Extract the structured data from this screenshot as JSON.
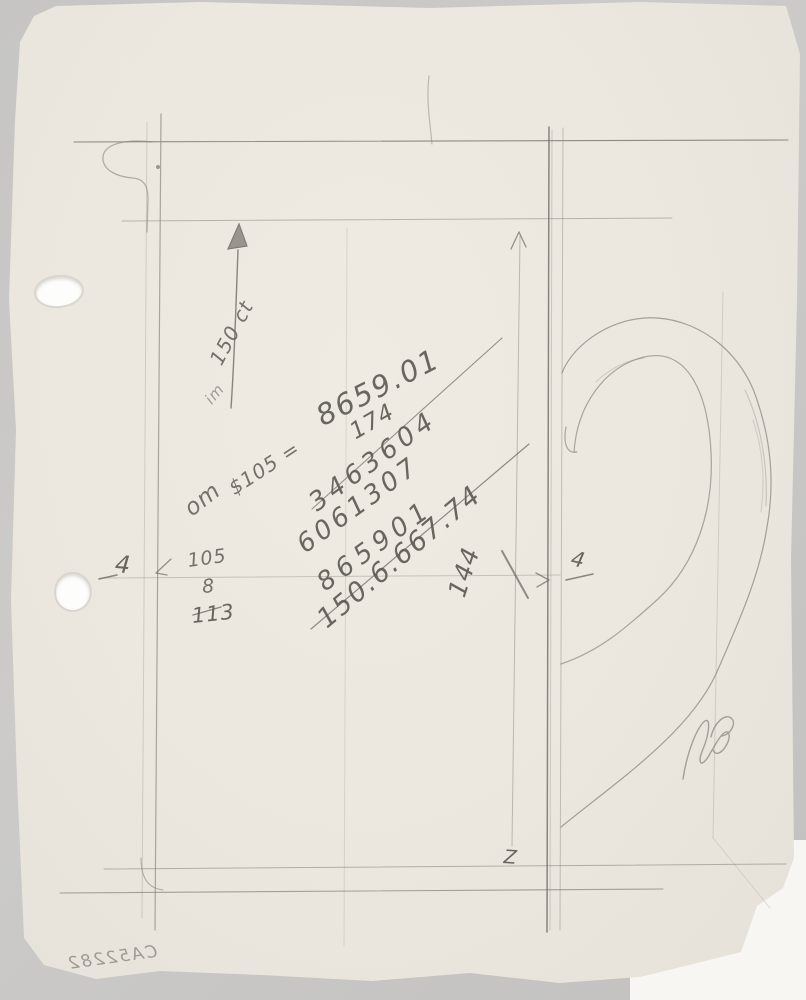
{
  "document": {
    "type": "pencil-sketch-scan",
    "title": "Hand-drawn pencil design sketch with handle profile, dimension arrows and arithmetic",
    "catalog_number": "CA52282"
  },
  "annotations": {
    "arrow_label": "150 ct",
    "small_note": "im",
    "equation_lead": "om",
    "equation_body": "$105 =",
    "equation_total": "8659.01",
    "multiplier": "174",
    "partial_product_1": "3463604",
    "partial_product_2": "6061307",
    "partial_product_3": "865901",
    "product_total": "150.6.667.74",
    "vertical_dimension": "144",
    "left_dimension_tick": "4",
    "right_dimension_tick": "4",
    "addition_top": "105",
    "addition_addend": "8",
    "addition_sum": "113",
    "bottom_marker": "Z"
  },
  "colors": {
    "paper": "#ebe7df",
    "background": "#c8c7c5",
    "pencil_light": "#8b8881",
    "pencil_dark": "#66635c",
    "under_sheet": "#f6f5f2"
  }
}
